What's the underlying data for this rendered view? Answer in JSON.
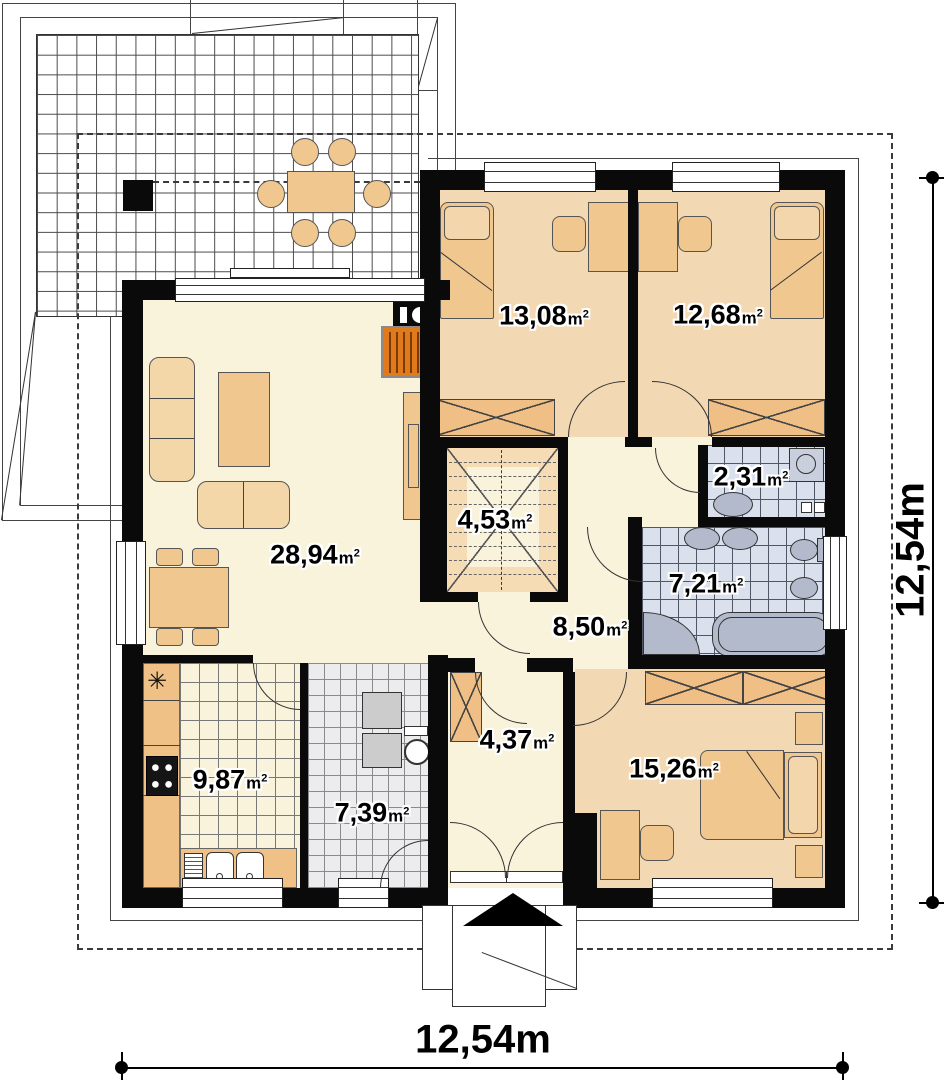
{
  "title": "single-storey house floor plan",
  "units": {
    "base": "m",
    "sup": "2"
  },
  "rooms": [
    {
      "id": "living-room",
      "area": "28,94"
    },
    {
      "id": "bedroom-1",
      "area": "13,08"
    },
    {
      "id": "bedroom-2",
      "area": "12,68"
    },
    {
      "id": "staircase",
      "area": "4,53"
    },
    {
      "id": "wc",
      "area": "2,31"
    },
    {
      "id": "bathroom",
      "area": "7,21"
    },
    {
      "id": "hallway",
      "area": "8,50"
    },
    {
      "id": "kitchen",
      "area": "9,87"
    },
    {
      "id": "utility-room",
      "area": "7,39"
    },
    {
      "id": "entry-hall",
      "area": "4,37"
    },
    {
      "id": "bedroom-3",
      "area": "15,26"
    }
  ],
  "dimensions": {
    "width_label": "12,54m",
    "height_label": "12,54m"
  },
  "symbols": {
    "kitchen_asterisk": "✳"
  },
  "colors": {
    "wall": "#0a0a0a",
    "floor_light": "#FAF3DB",
    "floor_bedroom": "#F2D9B3",
    "furniture_tan": "#F0C78E",
    "tile_bath": "#DAE1ED",
    "tile_utility": "#ECECEF",
    "counter_orange": "#F0C187",
    "fireplace_orange": "#E1791D",
    "fixture_gray": "#B3BACB"
  }
}
